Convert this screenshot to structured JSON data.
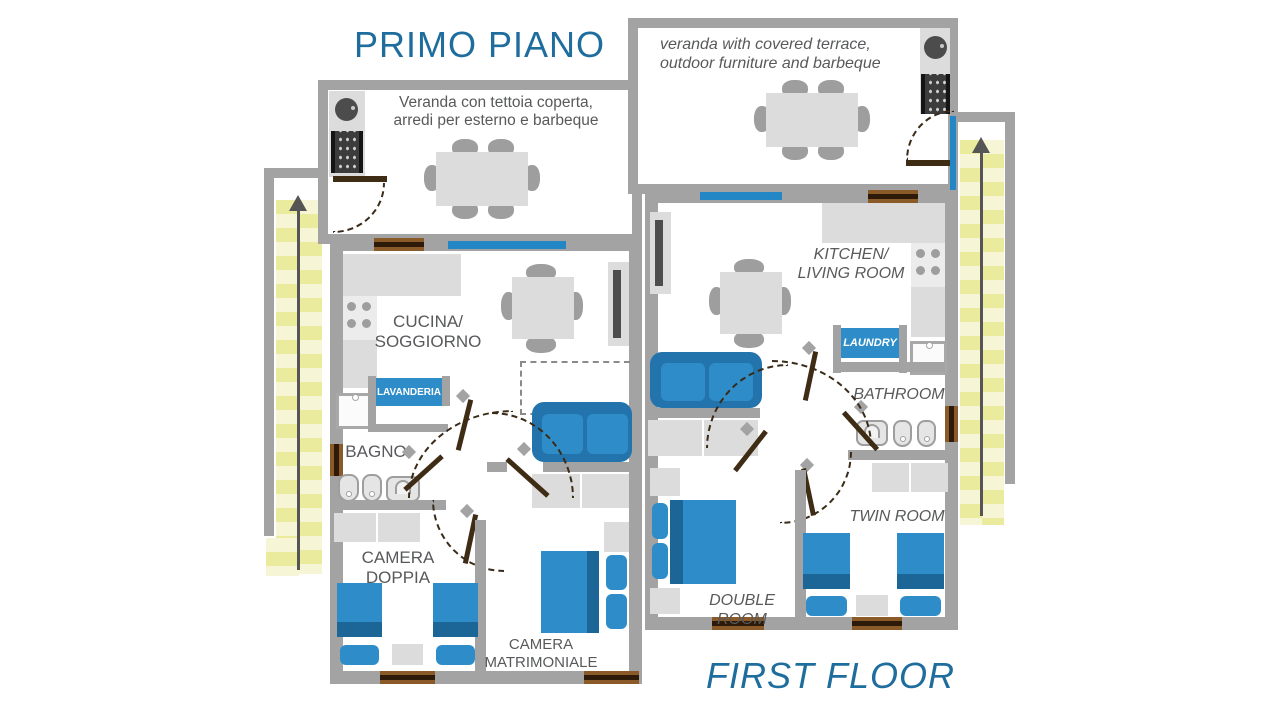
{
  "colors": {
    "accent_blue": "#1e6d9d",
    "furniture_blue": "#2e8dc8",
    "furniture_blue_dark": "#1c6697",
    "wall_gray": "#a3a3a3",
    "light_gray_furniture": "#dcdcdc",
    "stairs_yellow": "#ebeb9e",
    "door_brown": "#3f2c14",
    "window_blue": "#2287c4",
    "label_gray": "#58595b"
  },
  "titles": {
    "italian": "PRIMO PIANO",
    "english": "FIRST FLOOR"
  },
  "plan_left": {
    "veranda_line1": "Veranda con tettoia coperta,",
    "veranda_line2": "arredi per esterno e barbeque",
    "kitchen_line1": "CUCINA/",
    "kitchen_line2": "SOGGIORNO",
    "laundry": "LAVANDERIA",
    "bathroom": "BAGNO",
    "twin_line1": "CAMERA",
    "twin_line2": "DOPPIA",
    "double_line1": "CAMERA",
    "double_line2": "MATRIMONIALE"
  },
  "plan_right": {
    "veranda_line1": "veranda with covered terrace,",
    "veranda_line2": "outdoor furniture and barbeque",
    "kitchen_line1": "KITCHEN/",
    "kitchen_line2": "LIVING ROOM",
    "laundry": "LAUNDRY",
    "bathroom": "BATHROOM",
    "twin": "TWIN ROOM",
    "double": "DOUBLE ROOM"
  }
}
